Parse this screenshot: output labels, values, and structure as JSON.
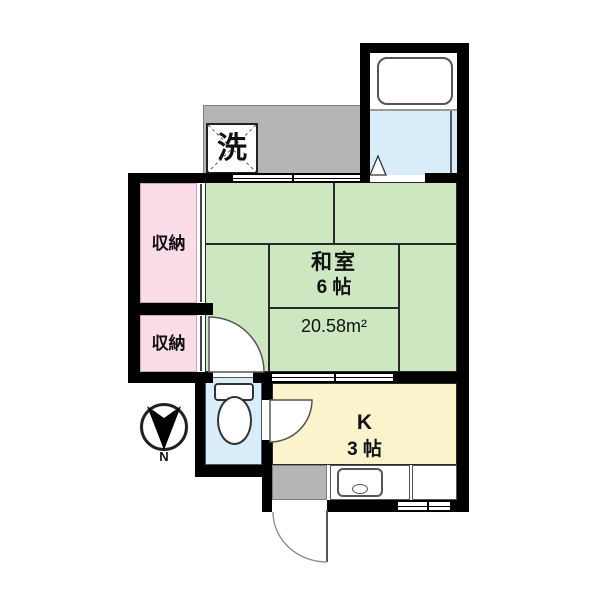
{
  "floorplan": {
    "balcony": {
      "laundry_label": "洗"
    },
    "closet_upper": {
      "label": "収納"
    },
    "closet_lower": {
      "label": "収納"
    },
    "washitsu": {
      "name": "和室",
      "size": "6 帖",
      "area": "20.58m²"
    },
    "kitchen": {
      "name": "K",
      "size": "3 帖"
    },
    "compass": {
      "north_label": "N"
    },
    "colors": {
      "wall_black": "#000000",
      "tatami_green": "#cde8c0",
      "closet_pink": "#fbdde9",
      "wet_area_blue": "#d8edf8",
      "kitchen_yellow": "#faf3cc",
      "balcony_gray": "#b5b5b5"
    }
  }
}
